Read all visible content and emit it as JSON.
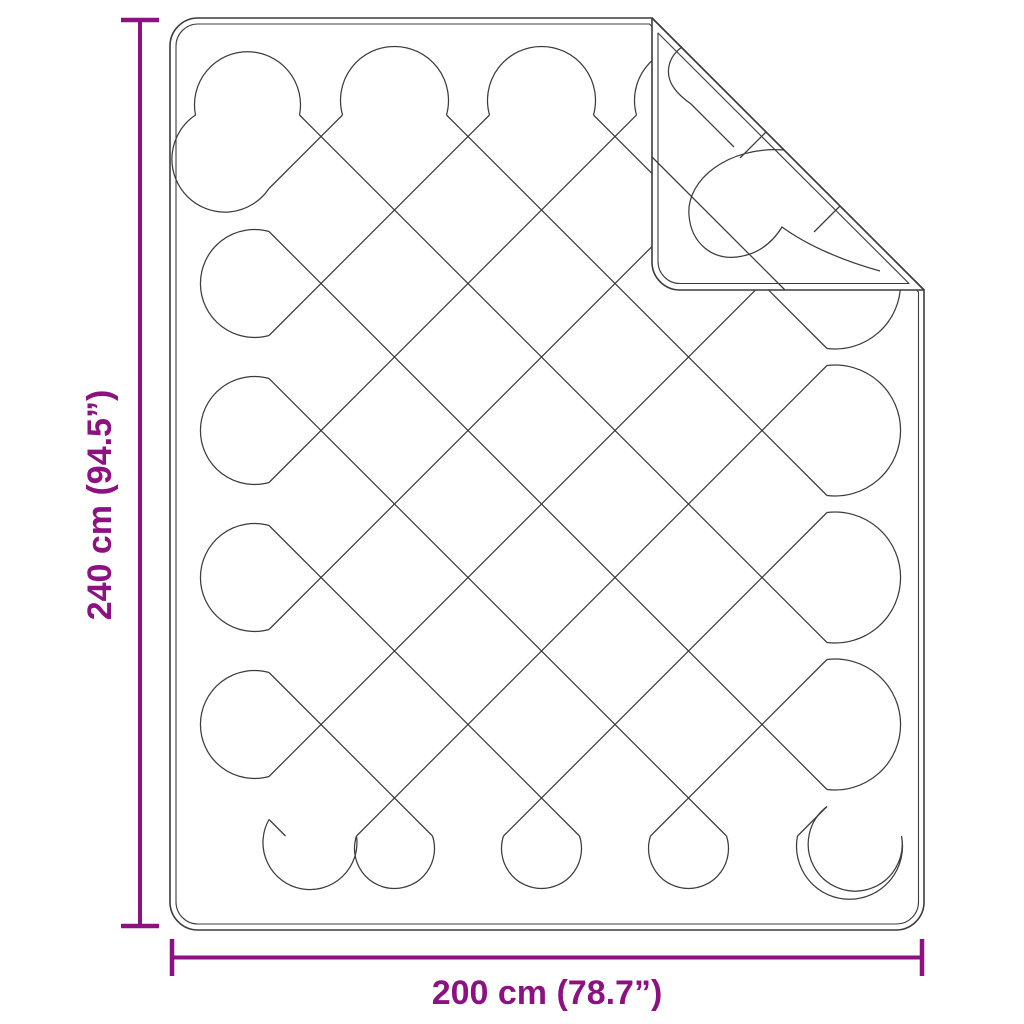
{
  "diagram": {
    "height_label": "240 cm (94.5”)",
    "width_label": "200 cm (78.7”)",
    "colors": {
      "dimension": "#8E1182",
      "line_art": "#3C3C3C",
      "background": "#FFFFFF"
    }
  }
}
